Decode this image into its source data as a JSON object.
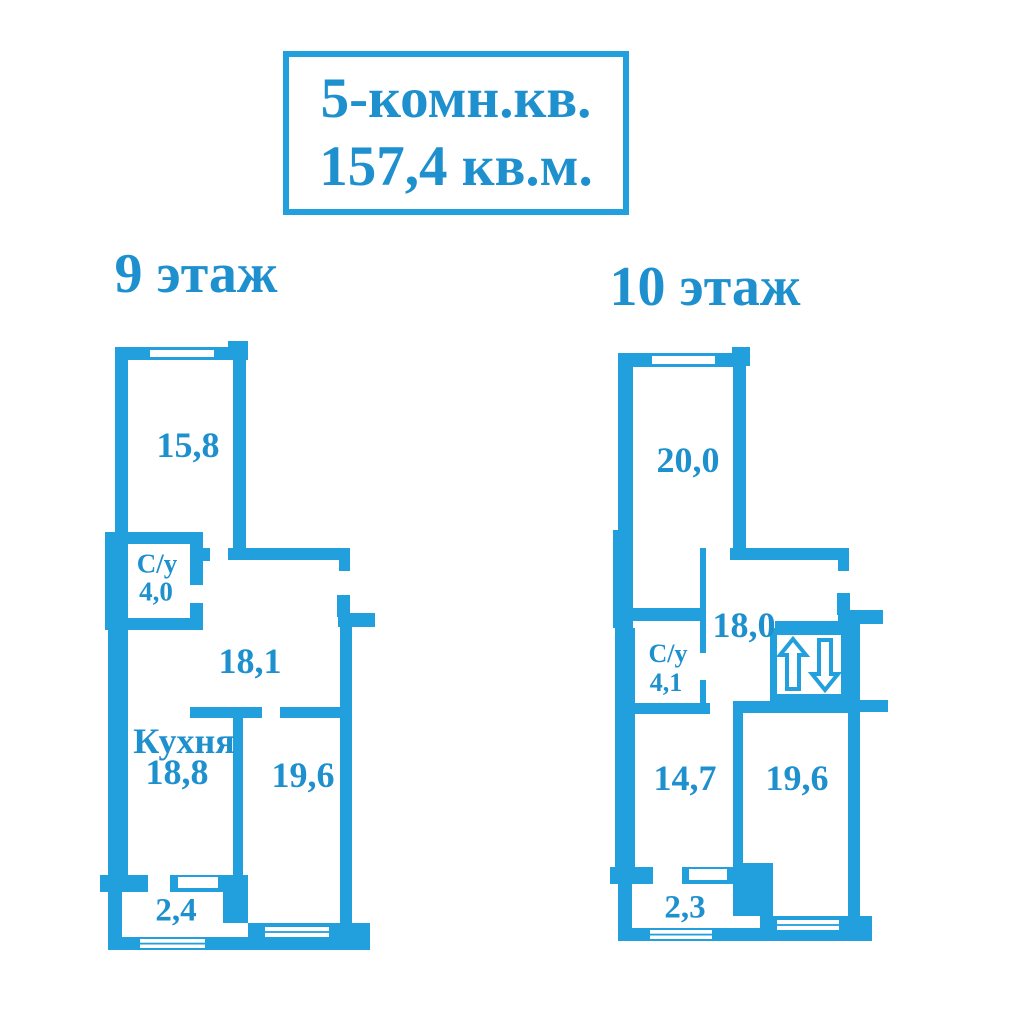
{
  "title": {
    "line1": "5-комн.кв.",
    "line2": "157,4 кв.м."
  },
  "colors": {
    "wall_blue": "#22A0DD",
    "text_blue": "#1E90CE",
    "background": "#FFFFFF"
  },
  "icons": {
    "lift": "up-down-arrows-icon",
    "windows": "double-line-window"
  },
  "floors": [
    {
      "label": "9 этаж",
      "rooms": [
        {
          "id": "room-top",
          "label": "15,8"
        },
        {
          "id": "bathroom",
          "label": "С/у",
          "area": "4,0"
        },
        {
          "id": "hall",
          "label": "18,1"
        },
        {
          "id": "kitchen",
          "label": "Кухня",
          "area": "18,8"
        },
        {
          "id": "room-right",
          "label": "19,6"
        },
        {
          "id": "balcony",
          "label": "2,4"
        }
      ]
    },
    {
      "label": "10 этаж",
      "rooms": [
        {
          "id": "room-top",
          "label": "20,0"
        },
        {
          "id": "hall",
          "label": "18,0"
        },
        {
          "id": "bathroom",
          "label": "С/у",
          "area": "4,1"
        },
        {
          "id": "room-left",
          "label": "14,7"
        },
        {
          "id": "room-right",
          "label": "19,6"
        },
        {
          "id": "balcony",
          "label": "2,3"
        }
      ]
    }
  ]
}
